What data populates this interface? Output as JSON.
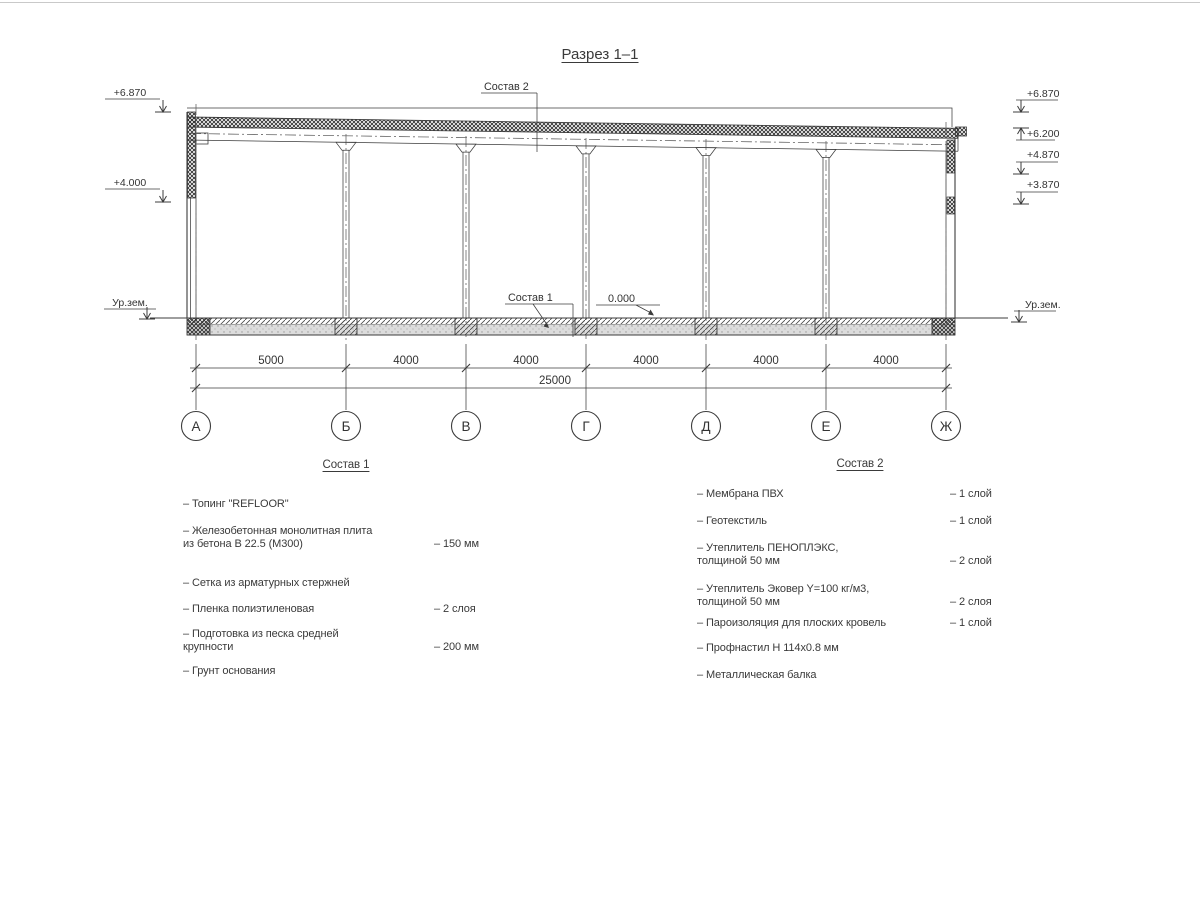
{
  "title": "Разрез 1–1",
  "drawing": {
    "callout_sostav2": "Состав 2",
    "callout_sostav1": "Состав 1",
    "zero_mark": "0.000",
    "ground_left": "Ур.зем.",
    "ground_right": "Ур.зем.",
    "elev_left": [
      "+6.870",
      "+4.000"
    ],
    "elev_right": [
      "+6.870",
      "+6.200",
      "+4.870",
      "+3.870"
    ],
    "axes": [
      "А",
      "Б",
      "В",
      "Г",
      "Д",
      "Е",
      "Ж"
    ],
    "dims": [
      "5000",
      "4000",
      "4000",
      "4000",
      "4000",
      "4000"
    ],
    "dim_total": "25000"
  },
  "sostav1": {
    "heading": "Состав 1",
    "items": [
      {
        "name": "– Топинг \"REFLOOR\"",
        "value": ""
      },
      {
        "name": "– Железобетонная  монолитная плита\nиз бетона В 22.5 (М300)",
        "value": "– 150 мм"
      },
      {
        "name": "– Сетка из арматурных стержней",
        "value": ""
      },
      {
        "name": "– Пленка полиэтиленовая",
        "value": "–  2 слоя"
      },
      {
        "name": "– Подготовка из песка средней\nкрупности",
        "value": "– 200 мм"
      },
      {
        "name": "– Грунт основания",
        "value": ""
      }
    ]
  },
  "sostav2": {
    "heading": "Состав 2",
    "items": [
      {
        "name": "– Мембрана ПВХ",
        "value": "– 1 слой"
      },
      {
        "name": "– Геотекстиль",
        "value": "– 1 слой"
      },
      {
        "name": "– Утеплитель ПЕНОПЛЭКС,\nтолщиной 50 мм",
        "value": "– 2 слой"
      },
      {
        "name": "– Утеплитель Эковер Y=100 кг/м3,\nтолщиной 50 мм",
        "value": "– 2 слоя"
      },
      {
        "name": "– Пароизоляция для плоских кровель",
        "value": "– 1 слой"
      },
      {
        "name": "– Профнастил Н 114х0.8 мм",
        "value": ""
      },
      {
        "name": "– Металлическая балка",
        "value": ""
      }
    ]
  },
  "colors": {
    "line": "#3c3c3c",
    "background": "#ffffff"
  }
}
